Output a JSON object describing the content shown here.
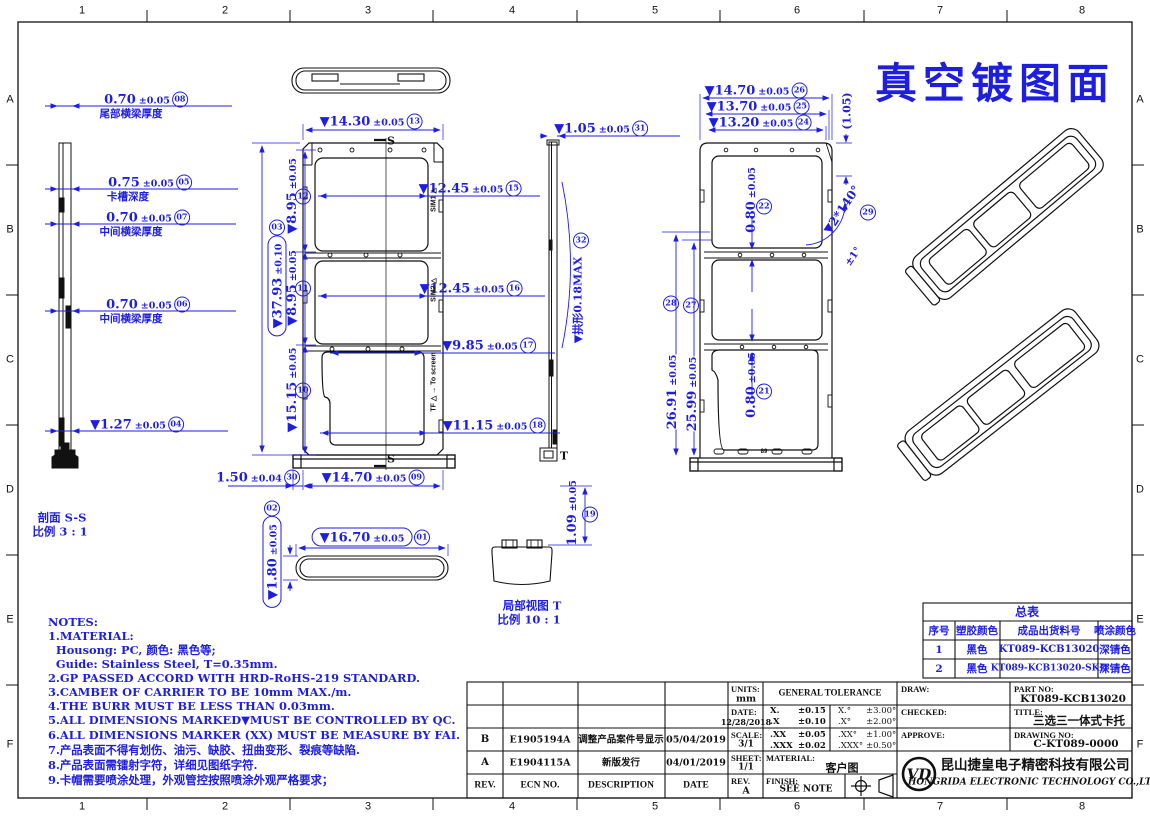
{
  "sheet": {
    "title": "真空镀图面"
  },
  "border": {
    "cols": [
      "1",
      "2",
      "3",
      "4",
      "5",
      "6",
      "7",
      "8"
    ],
    "rows": [
      "A",
      "B",
      "C",
      "D",
      "E",
      "F"
    ]
  },
  "colors": {
    "dim_blue": "#1e1ee0",
    "line_black": "#111111"
  },
  "views": {
    "section_ss_1": "剖面 S-S",
    "section_ss_2": "比例 3 : 1",
    "detail_t_1": "局部视图 T",
    "detail_t_2": "比例 10 : 1",
    "section_letter": "S",
    "detail_letter": "T"
  },
  "markings": {
    "sim1": "SIM1 △",
    "sim2": "SIM2 △",
    "tf": "TF △ → To screen",
    "bottom": "89"
  },
  "dims": {
    "d01": {
      "v": "▼16.70",
      "t": "±0.05",
      "b": "01"
    },
    "d02": {
      "v": "▼1.80",
      "t": "±0.05",
      "b": "02"
    },
    "d03": {
      "v": "▼37.93",
      "t": "±0.10",
      "b": "03"
    },
    "d04": {
      "v": "▼1.27",
      "t": "±0.05",
      "b": "04"
    },
    "d05": {
      "v": "0.75",
      "t": "±0.05",
      "b": "05",
      "label": "卡槽深度"
    },
    "d06": {
      "v": "0.70",
      "t": "±0.05",
      "b": "06",
      "label": "中间横梁厚度"
    },
    "d07": {
      "v": "0.70",
      "t": "±0.05",
      "b": "07",
      "label": "中间横梁厚度"
    },
    "d08": {
      "v": "0.70",
      "t": "±0.05",
      "b": "08",
      "label": "尾部横梁厚度"
    },
    "d09": {
      "v": "▼14.70",
      "t": "±0.05",
      "b": "09"
    },
    "d10": {
      "v": "▼15.15",
      "t": "±0.05",
      "b": "10"
    },
    "d11": {
      "v": "▼8.95",
      "t": "±0.05",
      "b": "11"
    },
    "d12": {
      "v": "▼8.95",
      "t": "±0.05",
      "b": "12"
    },
    "d13": {
      "v": "▼14.30",
      "t": "±0.05",
      "b": "13"
    },
    "d15": {
      "v": "▼12.45",
      "t": "±0.05",
      "b": "15"
    },
    "d16": {
      "v": "▼12.45",
      "t": "±0.05",
      "b": "16"
    },
    "d17": {
      "v": "▼9.85",
      "t": "±0.05",
      "b": "17"
    },
    "d18": {
      "v": "▼11.15",
      "t": "±0.05",
      "b": "18"
    },
    "d19": {
      "v": "1.09",
      "t": "±0.05",
      "b": "19"
    },
    "d21": {
      "v": "0.80",
      "t": "±0.05",
      "b": "21"
    },
    "d22": {
      "v": "0.80",
      "t": "±0.05",
      "b": "22"
    },
    "d24": {
      "v": "▼13.20",
      "t": "±0.05",
      "b": "24"
    },
    "d25": {
      "v": "▼13.70",
      "t": "±0.05",
      "b": "25"
    },
    "d26": {
      "v": "▼14.70",
      "t": "±0.05",
      "b": "26"
    },
    "d27": {
      "v": "25.99",
      "t": "±0.05",
      "b": "27"
    },
    "d28": {
      "v": "26.91",
      "t": "±0.05",
      "b": "28"
    },
    "d29": {
      "v": "▼2*140°",
      "t": "±1°",
      "b": "29"
    },
    "d30": {
      "v": "1.50",
      "t": "±0.04",
      "b": "30"
    },
    "d31": {
      "v": "▼1.05",
      "t": "±0.05",
      "b": "31"
    },
    "d32": {
      "v": "▼拱形0.18MAX",
      "b": "32"
    },
    "ref105": {
      "v": "(1.05)"
    }
  },
  "notes": {
    "lines": [
      "NOTES:",
      "1.MATERIAL:",
      "  Housong: PC, 颜色: 黑色等;",
      "  Guide: Stainless Steel, T=0.35mm.",
      "2.GP PASSED ACCORD WITH HRD-RoHS-219 STANDARD.",
      "3.CAMBER OF CARRIER TO BE 10mm MAX./m.",
      "4.THE BURR MUST BE LESS THAN 0.03mm.",
      "5.ALL DIMENSIONS MARKED▼MUST BE CONTROLLED BY QC.",
      "6.ALL DIMENSIONS MARKER (XX) MUST BE MEASURE BY FAI.",
      "7.产品表面不得有划伤、油污、缺胶、扭曲变形、裂痕等缺陷.",
      "8.产品表面需镭射字符，详细见图纸字符.",
      "9.卡帽需要喷涂处理，外观管控按照喷涂外观严格要求；"
    ]
  },
  "summary": {
    "title": "总表",
    "headers": [
      "序号",
      "塑胶颜色",
      "成品出货料号",
      "喷涂颜色"
    ],
    "rows": [
      [
        "1",
        "黑色",
        "KT089-KCB13020",
        "深锖色"
      ],
      [
        "2",
        "黑色",
        "KT089-KCB13020-SKD",
        "深锖色"
      ]
    ]
  },
  "revisions": {
    "headers": [
      "REV.",
      "ECN NO.",
      "DESCRIPTION",
      "DATE"
    ],
    "rows": [
      [
        "B",
        "E1905194A",
        "调整产品案件号显示",
        "05/04/2019"
      ],
      [
        "A",
        "E1904115A",
        "新版发行",
        "04/01/2019"
      ]
    ]
  },
  "info": {
    "units_label": "UNITS:",
    "units": "mm",
    "date_label": "DATE:",
    "date": "12/28/2018",
    "scale_label": "SCALE:",
    "scale": "3/1",
    "sheet_label": "SHEET:",
    "sheet": "1/1",
    "rev_label": "REV.",
    "rev": "A"
  },
  "tolerance": {
    "title": "GENERAL TOLERANCE",
    "rows": [
      [
        "X.",
        "±0.15",
        "X.°",
        "±3.00°"
      ],
      [
        ".X",
        "±0.10",
        ".X°",
        "±2.00°"
      ],
      [
        ".XX",
        "±0.05",
        ".XX°",
        "±1.00°"
      ],
      [
        ".XXX",
        "±0.02",
        ".XXX°",
        "±0.50°"
      ]
    ]
  },
  "material": {
    "label": "MATERIAL:",
    "value": "客户图"
  },
  "finish": {
    "label": "FINISH:",
    "value": "SEE NOTE"
  },
  "approvals": {
    "draw": "DRAW:",
    "checked": "CHECKED:",
    "approve": "APPROVE:"
  },
  "ids": {
    "part_label": "PART NO:",
    "part": "KT089-KCB13020",
    "title_label": "TITLE:",
    "title": "三选三一体式卡托",
    "drawing_label": "DRAWING NO:",
    "drawing": "C-KT089-0000"
  },
  "company": {
    "logo": "VD",
    "cn": "昆山捷皇电子精密科技有限公司",
    "en": "HONGRIDA ELECTRONIC TECHNOLOGY CO.,LTD."
  }
}
